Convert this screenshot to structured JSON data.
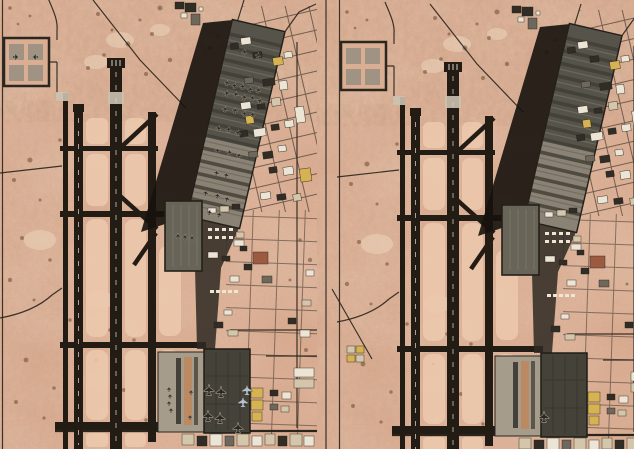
{
  "scene": {
    "type": "satellite-image-comparison",
    "subject": "desert airbase with parallel runways, a large diagonal parking apron, alert pad and support/building areas",
    "layout": "two panels side by side",
    "visible_text": "none"
  },
  "panels": [
    {
      "id": "before",
      "position": "left",
      "description": "Satellite view of the airbase with many aircraft parked on the diagonal apron, alert pad, central apron and south aprons",
      "aircraft_visible": true,
      "aircraft_counts": {
        "diagonal_apron": 29,
        "alert_pad": 2,
        "central_apron": 3,
        "south_light_apron": 6,
        "south_dark_apron": 7
      }
    },
    {
      "id": "after",
      "position": "right",
      "description": "Same airbase view at a later date with the parking aprons nearly empty",
      "aircraft_visible": false,
      "residual_aircraft_visible": true,
      "aircraft_counts": {
        "south_dark_apron": 1
      }
    }
  ],
  "colors": {
    "desert": "#dcab90",
    "infield": "#ecc9ad",
    "runway": "#221c15",
    "road": "#2a241c",
    "apron_dark": "#56534a",
    "apron_light": "#8a8274",
    "stripe_dark": "#403d34",
    "stripe_light": "#6f6b5e",
    "shadow": "#16120d",
    "apron_central": "#696458",
    "apron_south": "#45423a",
    "pad_light": "#a59c8c",
    "jet_dark": "#2c2821",
    "jet_light": "#b7c0c6",
    "b_white": "#ece4d4",
    "b_tan": "#d4c6ab",
    "b_yellow": "#d6b253",
    "b_dark": "#312d26",
    "b_gray": "#6e675b",
    "b_red": "#9c5a40"
  }
}
